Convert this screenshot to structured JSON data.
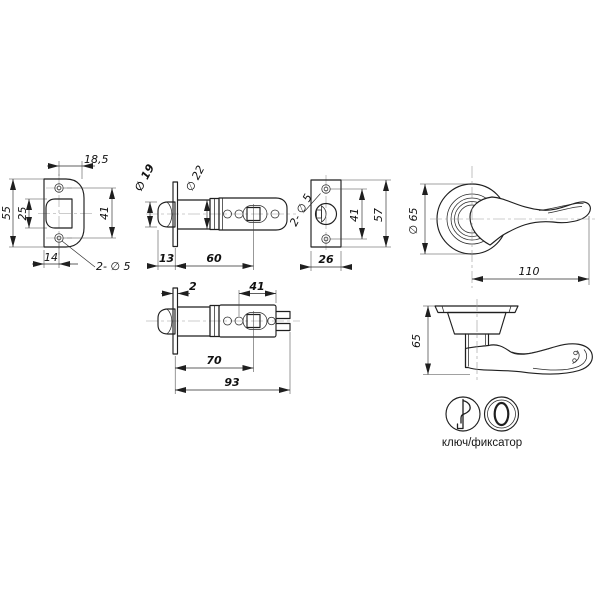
{
  "caption": "ключ/фиксатор",
  "colors": {
    "line": "#1f1f1f",
    "background": "#ffffff"
  },
  "views": {
    "faceplate": {
      "dims": {
        "top_width": "18,5",
        "height": "55",
        "cutout_height": "25",
        "hole_spacing": "41",
        "left_offset": "14",
        "holes_note": "2- ∅ 5"
      }
    },
    "latch60": {
      "dims": {
        "bolt_dia": "∅ 19",
        "body_dia": "∅ 22",
        "head_len": "13",
        "backset": "60"
      }
    },
    "strike": {
      "dims": {
        "holes_note": "2- ∅ 5",
        "hole_spacing": "41",
        "height": "57",
        "width": "26"
      }
    },
    "handle_front": {
      "dims": {
        "rose_dia": "∅ 65",
        "length": "110"
      }
    },
    "latch70": {
      "dims": {
        "flange": "2",
        "tail": "41",
        "backset": "70",
        "total": "93"
      }
    },
    "handle_side": {
      "dims": {
        "height": "65"
      }
    }
  }
}
